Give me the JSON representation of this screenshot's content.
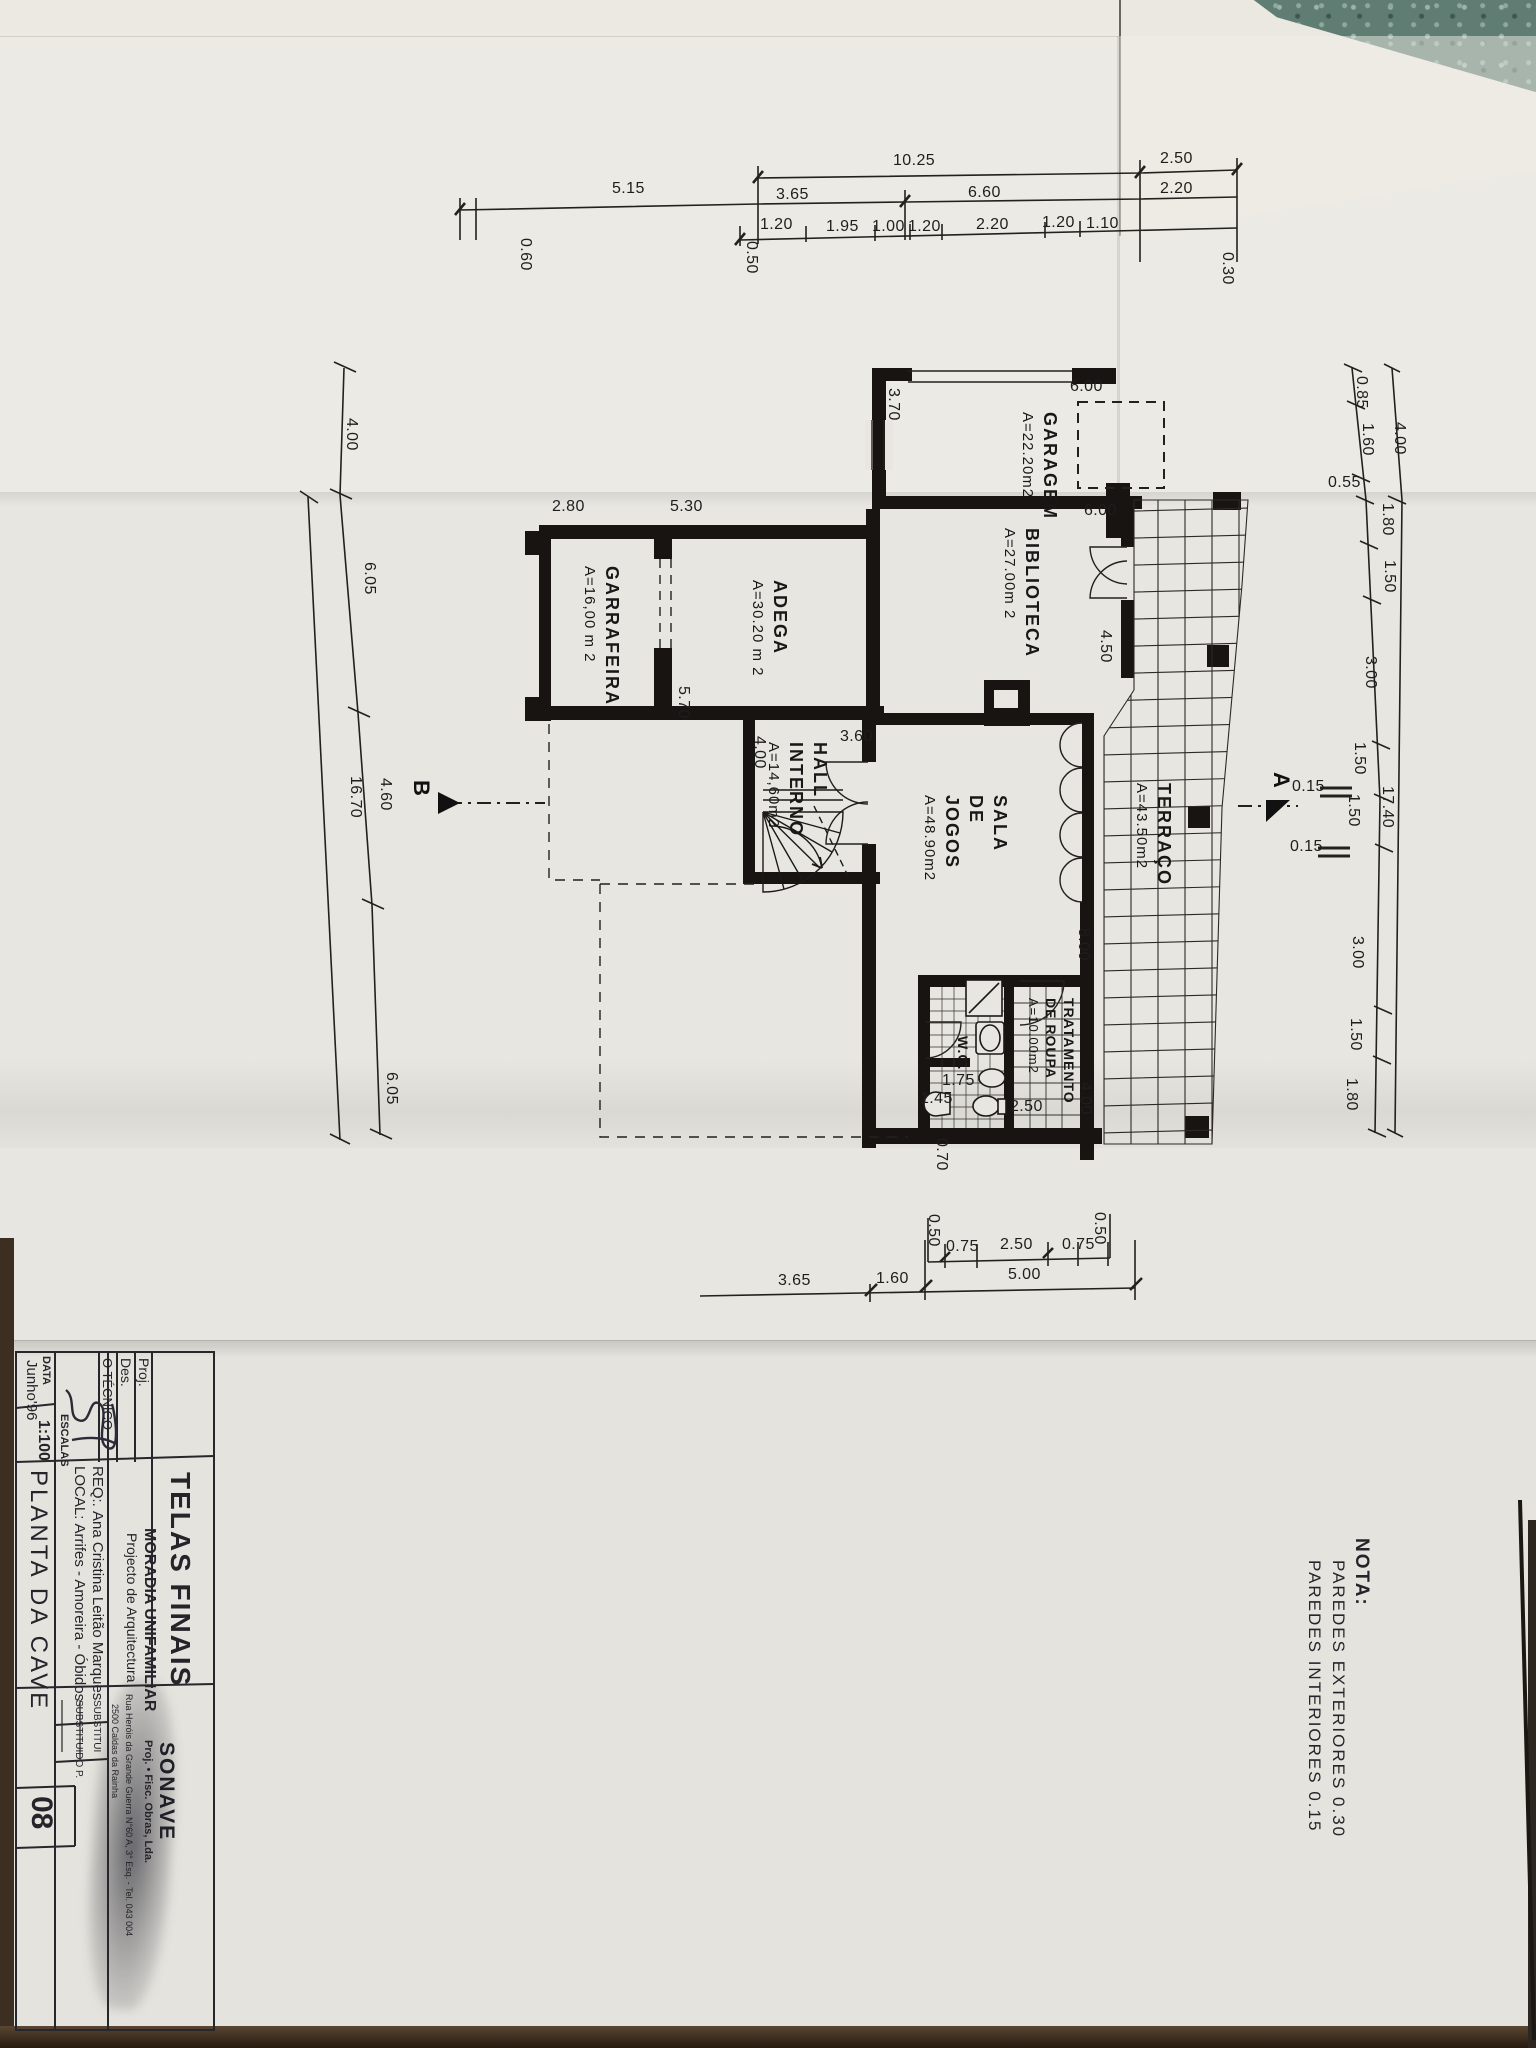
{
  "note": {
    "title": "NOTA:",
    "line1": "PAREDES  EXTERIORES  0.30",
    "line2": "PAREDES  INTERIORES  0.15"
  },
  "title_block": {
    "sheet_title": "TELAS FINAIS",
    "project": "MORADIA UNIFAMILIAR",
    "project_sub": "Projecto de Arquitectura",
    "proj_label": "Proj.",
    "des_label": "Des.",
    "tecnico_label": "O TÉCNICO",
    "req_label": "REQ:.",
    "req_value": "Ana Cristina Leitão Marques",
    "local_label": "LOCAL:",
    "local_value": "Arrifes - Amoreira - Óbidos",
    "data_label": "DATA",
    "data_value": "Junho'96",
    "escalas_label": "ESCALAS",
    "escalas_value": "1:100",
    "drawing_title": "PLANTA  DA  CAVE",
    "substitui_label": "SUBSTITUI",
    "substituido_label": "SUBSTITUIDO P.",
    "sheet_number": "08",
    "company": "SONAVE",
    "company_sub": "Proj. • Fisc. Obras, Lda.",
    "company_addr1": "Rua Heróis da Grande Guerra N°60 A, 3° Esq. - Tel. 043 004",
    "company_addr2": "2500 Caldas da Rainha"
  },
  "markers": {
    "a": "A",
    "b": "B"
  },
  "rooms": [
    {
      "name": "GARAGEM",
      "area": "A=22.20m2"
    },
    {
      "name": "BIBLIOTECA",
      "area": "A=27.00m 2"
    },
    {
      "name": "GARRAFEIRA",
      "area": "A=16,00 m 2"
    },
    {
      "name": "ADEGA",
      "area": "A=30.20 m 2"
    },
    {
      "name": "HALL\nINTERNO",
      "area": "A=14,60m2"
    },
    {
      "name": "SALA\nDE\nJOGOS",
      "area": "A=48.90m2"
    },
    {
      "name": "TERRAÇO",
      "area": "A=43.50m2"
    },
    {
      "name": "TRATAMENTO\nDE ROUPA",
      "area": "A=10.00m2"
    },
    {
      "name": "W.C.",
      "area": ""
    }
  ],
  "dims": {
    "top1": [
      "10.25",
      "2.50"
    ],
    "top2": [
      "5.15",
      "3.65",
      "6.60",
      "2.20"
    ],
    "top3": [
      "1.20",
      "1.95",
      "1.00",
      "1.20",
      "2.20",
      "1.20",
      "1.10"
    ],
    "top_side": [
      "0.60",
      "0.50",
      "0.30"
    ],
    "left": [
      "4.00",
      "6.05",
      "16.70",
      "4.60",
      "6.05"
    ],
    "right": [
      "0.85",
      "1.60",
      "4.00",
      "0.55",
      "1.80",
      "1.50",
      "3.00",
      "1.50",
      "1.50",
      "17.40",
      "3.00",
      "1.50",
      "1.80"
    ],
    "bottom1": [
      "0.50",
      "0.75",
      "2.50",
      "0.75",
      "0.50"
    ],
    "bottom2": [
      "3.65",
      "1.60",
      "5.00"
    ],
    "interior": [
      "3.70",
      "6.00",
      "6.00",
      "2.80",
      "5.30",
      "5.70",
      "4.50",
      "3.60",
      "4.00",
      "8.00",
      "1.45",
      "1.75",
      "0.70",
      "2.50",
      "4.00"
    ],
    "wall_section": [
      "0.15",
      "0.15"
    ]
  }
}
